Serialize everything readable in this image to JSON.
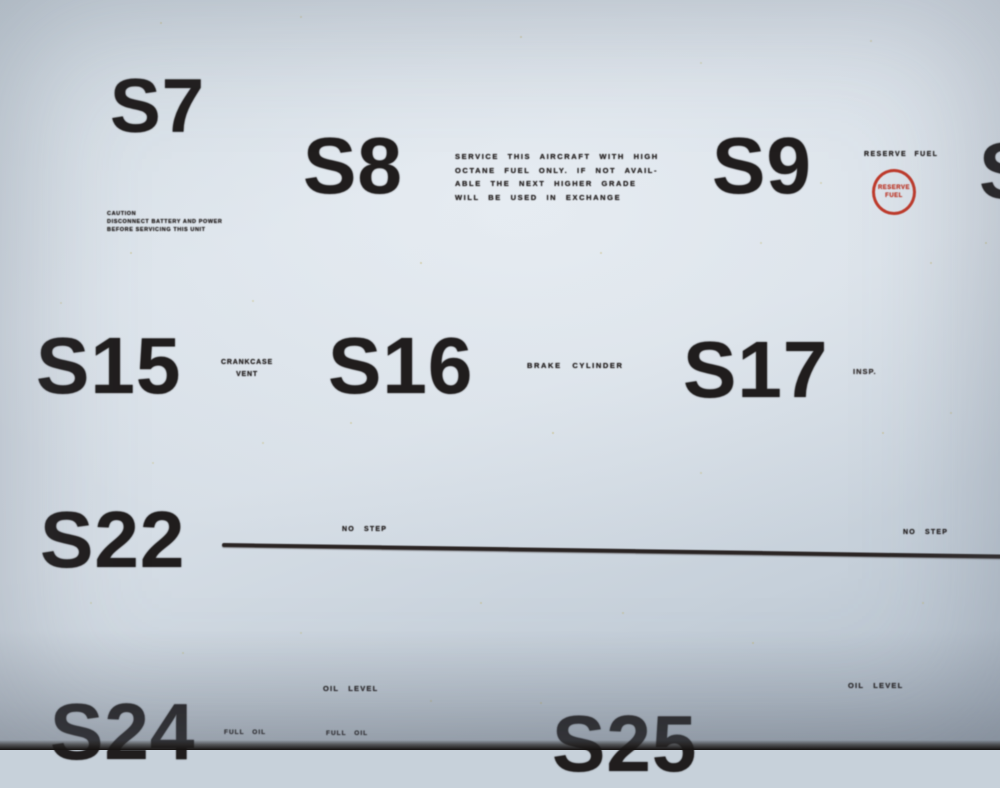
{
  "colors": {
    "paper_light": "#d8e0e8",
    "paper_dark": "#b4bfcb",
    "ink": "#201d1d",
    "stencil_red": "#bf3a2b",
    "speck_yellow": "#c1b25e"
  },
  "stencils": {
    "s7": {
      "number": "S7",
      "caution_lines": [
        "CAUTION",
        "DISCONNECT BATTERY AND POWER",
        "BEFORE SERVICING THIS UNIT"
      ]
    },
    "s8": {
      "number": "S8",
      "text_lines": [
        "SERVICE THIS AIRCRAFT WITH HIGH",
        "OCTANE FUEL ONLY. IF NOT AVAIL-",
        "ABLE THE NEXT HIGHER GRADE",
        "WILL BE USED IN EXCHANGE"
      ]
    },
    "s9": {
      "number": "S9",
      "label": "RESERVE FUEL",
      "circle_lines": [
        "RESERVE",
        "FUEL"
      ]
    },
    "s10_partial": {
      "number": "S"
    },
    "s15": {
      "number": "S15",
      "label_lines": [
        "CRANKCASE",
        "VENT"
      ]
    },
    "s16": {
      "number": "S16",
      "label": "BRAKE CYLINDER"
    },
    "s17": {
      "number": "S17",
      "label": "INSP."
    },
    "s22": {
      "number": "S22",
      "label_left": "NO STEP",
      "label_right": "NO STEP"
    },
    "s24": {
      "number": "S24",
      "label": "OIL LEVEL",
      "fragments": [
        "FULL OIL",
        "FULL OIL"
      ]
    },
    "s25": {
      "number": "S25",
      "label": "OIL LEVEL"
    }
  }
}
